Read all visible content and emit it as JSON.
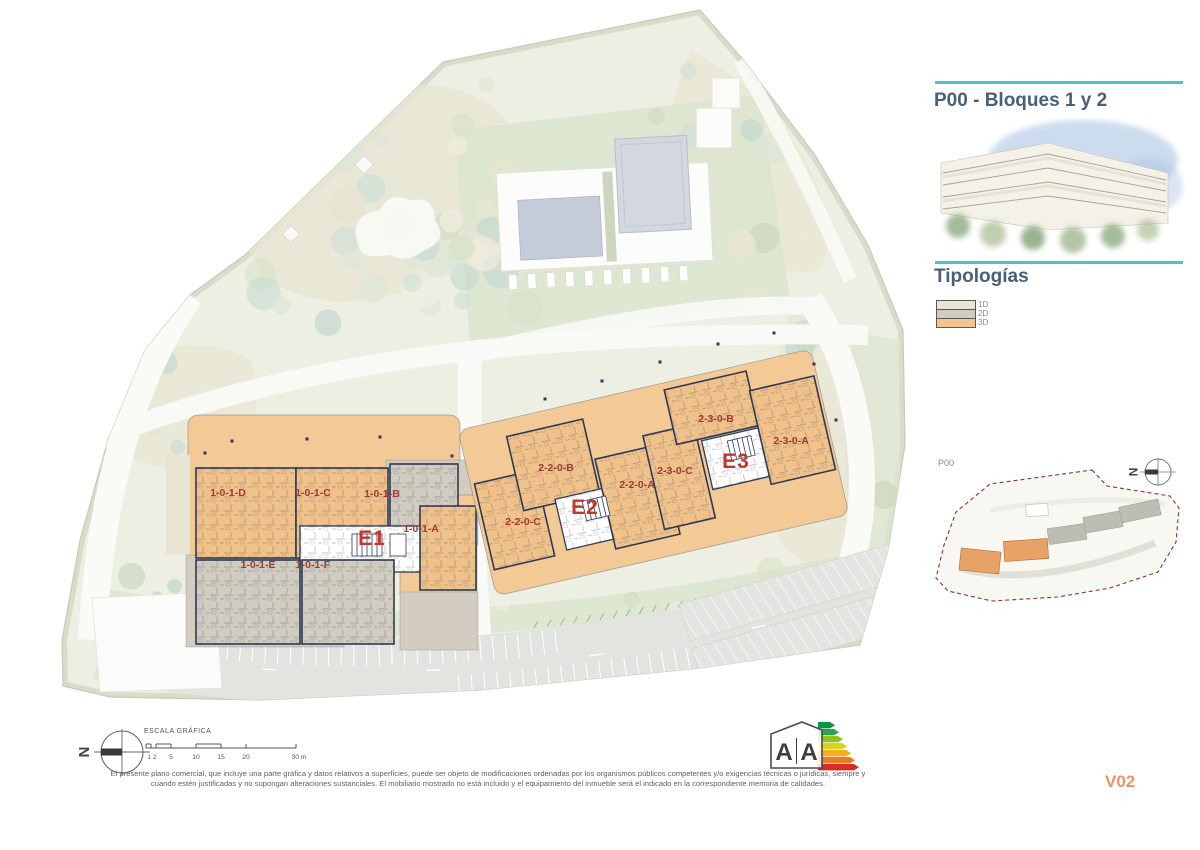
{
  "sidebar": {
    "title": "P00 - Bloques 1 y 2",
    "typologies_heading": "Tipologías",
    "typologies": [
      {
        "label": "1D",
        "color": "#e9e5d3"
      },
      {
        "label": "2D",
        "color": "#d1ccc0"
      },
      {
        "label": "3D",
        "color": "#f2c48e"
      }
    ],
    "keyplan": {
      "floor_label": "P00",
      "north_letter": "N"
    }
  },
  "plan": {
    "blocks": [
      {
        "core_label": "E1",
        "units": [
          "1-0-1-D",
          "1-0-1-C",
          "1-0-1-B",
          "1-0-1-A",
          "1-0-1-E",
          "1-0-1-F"
        ]
      },
      {
        "core_label": "E2",
        "units": [
          "2-2-0-C",
          "2-2-0-B",
          "2-2-0-A"
        ]
      },
      {
        "core_label": "E3",
        "units": [
          "2-3-0-C",
          "2-3-0-B",
          "2-3-0-A"
        ]
      }
    ],
    "north_letter": "N",
    "scalebar": {
      "title": "ESCALA GRÁFICA",
      "tick_labels": [
        "1 2",
        "5",
        "10",
        "15",
        "20",
        "30 m"
      ]
    }
  },
  "energy_label": {
    "letter_left": "A",
    "letter_right": "A"
  },
  "footer": {
    "disclaimer_line1": "El presente plano comercial, que incluye una parte gráfica y datos relativos a superficies, puede ser objeto de modificaciones ordenadas por los organismos públicos competentes y/o exigencias técnicas o jurídicas, siempre y",
    "disclaimer_line2": "cuando estén justificadas y no supongan alteraciones sustanciales. El mobiliario mostrado no está incluido y el equipamiento del inmueble será el indicado en la correspondiente memoria de calidades.",
    "version": "V02"
  },
  "colors": {
    "accent_teal": "#4fc1c7",
    "heading_blue": "#4a6076",
    "unit_label_red": "#a23a31",
    "core_label_red": "#c2372c",
    "version_orange": "#e5946b",
    "typology_1d_cream": "#e9e5d3",
    "typology_2d_grey": "#d1ccc0",
    "typology_3d_orange": "#f2c48e"
  }
}
